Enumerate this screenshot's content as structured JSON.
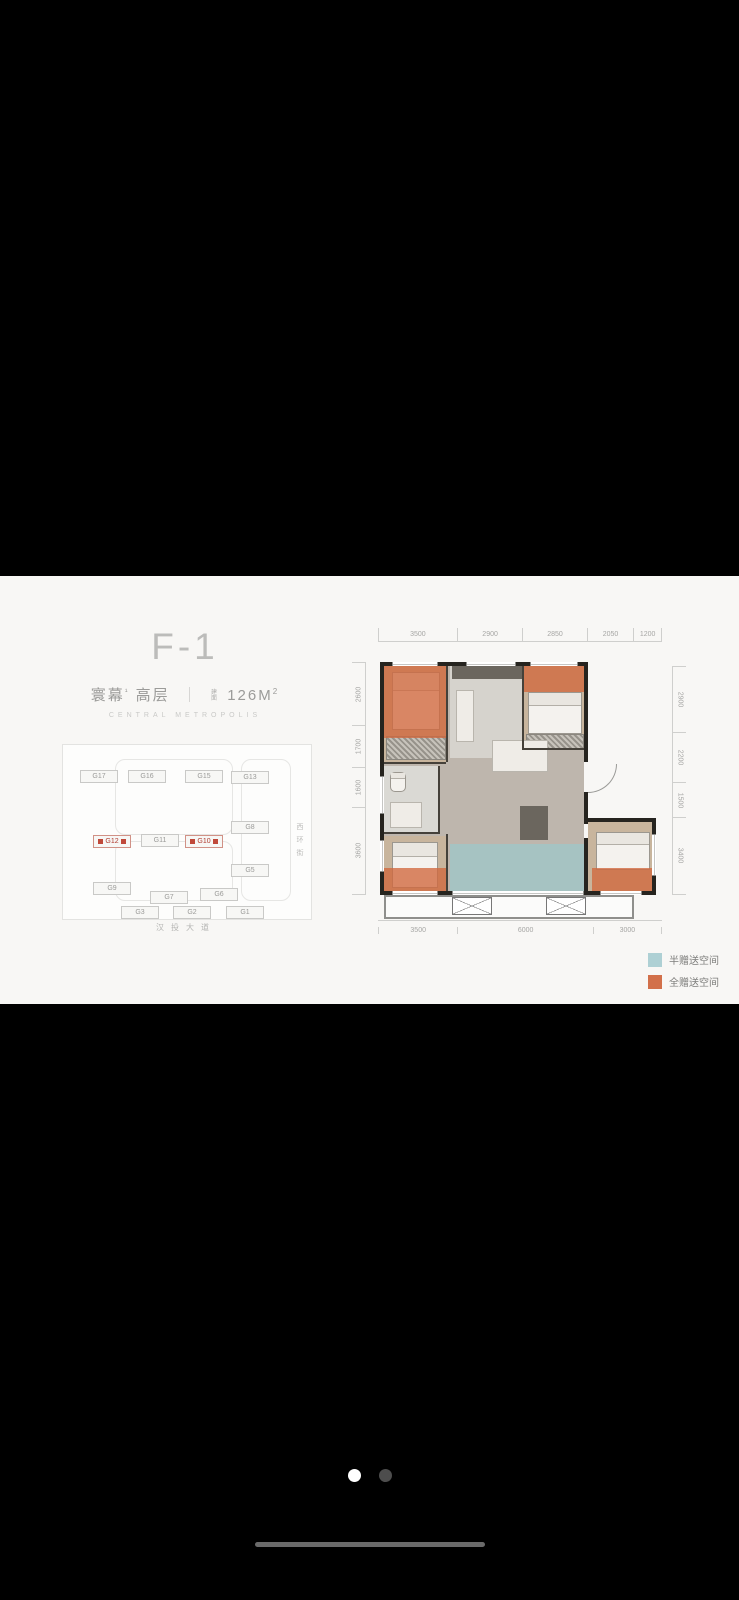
{
  "header": {
    "title": "F-1",
    "brand": "寰幕",
    "brand_sup": "¹",
    "type": "高层",
    "divider": "｜",
    "area_prefix_line1": "建",
    "area_prefix_line2": "面",
    "area_value": "126M",
    "area_sup": "2",
    "tagline": "CENTRAL METROPOLIS"
  },
  "siteplan": {
    "street_right": "西环街",
    "street_bottom": "汉投大道",
    "buildings": [
      {
        "id": "G17",
        "highlight": false
      },
      {
        "id": "G16",
        "highlight": false
      },
      {
        "id": "G15",
        "highlight": false
      },
      {
        "id": "G13",
        "highlight": false
      },
      {
        "id": "G8",
        "highlight": false
      },
      {
        "id": "G12",
        "highlight": true
      },
      {
        "id": "G11",
        "highlight": false
      },
      {
        "id": "G10",
        "highlight": true
      },
      {
        "id": "G5",
        "highlight": false
      },
      {
        "id": "G9",
        "highlight": false
      },
      {
        "id": "G7",
        "highlight": false
      },
      {
        "id": "G6",
        "highlight": false
      },
      {
        "id": "G3",
        "highlight": false
      },
      {
        "id": "G2",
        "highlight": false
      },
      {
        "id": "G1",
        "highlight": false
      }
    ]
  },
  "floorplan": {
    "dims_top": [
      "3500",
      "2900",
      "2850",
      "2050",
      "1200"
    ],
    "dims_bottom": [
      "3500",
      "6000",
      "3000"
    ],
    "dims_left": [
      "2600",
      "1700",
      "1600",
      "3600"
    ],
    "dims_right": [
      "2900",
      "2200",
      "1500",
      "3400"
    ]
  },
  "legend": {
    "items": [
      {
        "label": "半赠送空间",
        "color": "#aed0d4"
      },
      {
        "label": "全赠送空间",
        "color": "#d2704a"
      }
    ]
  },
  "colors": {
    "half_gift": "#aed0d4",
    "full_gift": "#d2704a",
    "wall": "#26241f"
  }
}
